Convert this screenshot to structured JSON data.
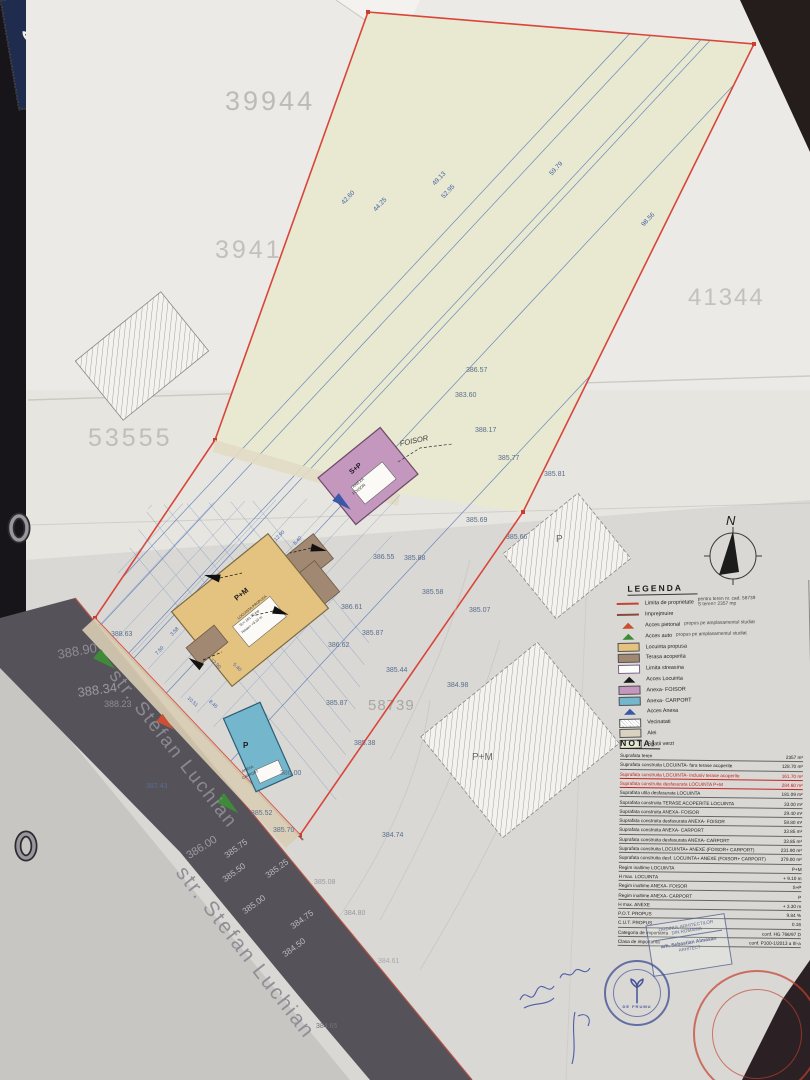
{
  "colors": {
    "boundary_red": "#d9453a",
    "parcel_green": "#e8e9d0",
    "house_tan": "#e4c380",
    "terrace_brown": "#a08873",
    "foisor_pink": "#c497bf",
    "carport_cyan": "#74b7cd",
    "street_gray": "#56525a",
    "survey_blue": "#5577b8",
    "nota_red": "#c32222"
  },
  "map": {
    "north_label": "N",
    "street_name": "str. Stefan Luchian",
    "parcel_ids": [
      "39944",
      "39416",
      "53555",
      "41344",
      "58739",
      "41344"
    ],
    "line_labels": [
      "42.60",
      "44.25",
      "49.13",
      "52.95",
      "59.79",
      "98.56"
    ],
    "dimensions": [
      "12.90",
      "5.40",
      "7.50",
      "3.58",
      "10.51",
      "8.45",
      "5.40",
      "12.90"
    ],
    "elevations": [
      "383.60",
      "388.17",
      "385.77",
      "385.81",
      "385.69",
      "385.66",
      "386.57",
      "386.55",
      "385.88",
      "385.58",
      "385.07",
      "386.61",
      "385.87",
      "386.62",
      "385.44",
      "384.98",
      "385.87",
      "385.38",
      "386.00",
      "385.52",
      "385.70",
      "384.74",
      "388.63",
      "388.90",
      "388.34",
      "388.23",
      "387.43",
      "386.00",
      "385.75",
      "385.50",
      "385.25",
      "385.08",
      "385.00",
      "384.75",
      "384.80",
      "384.50",
      "384.61",
      "384.65"
    ],
    "buildings": {
      "house": {
        "label": "P+M",
        "tag1": "LOCUINTA PROPUSA",
        "tag2": "Sc= 161.70 mp",
        "tag3": "Hmax= +9.10 m"
      },
      "foisor": {
        "label": "S+P",
        "callout": "FOISOR",
        "tag1": "ANEXA",
        "tag2": "FOISOR"
      },
      "carport": {
        "label": "P",
        "tag1": "ANEXA",
        "tag2": "CARPORT"
      },
      "neighbor_p": "P",
      "neighbor_pm": "P+M"
    }
  },
  "legend": {
    "title": "LEGENDA",
    "items": [
      {
        "label": "Limita de proprietate",
        "note": "pentru teren  nr. cad. 58739",
        "note2": "S teren= 2357 mp"
      },
      {
        "label": "Imprejmuire"
      },
      {
        "label": "Acces pietonal",
        "note": "propus pe amplasamentul studiat"
      },
      {
        "label": "Acces auto",
        "note": "propus pe amplasamentul studiat"
      },
      {
        "label": "Locuinta propusa"
      },
      {
        "label": "Terasa acoperita"
      },
      {
        "label": "Limita streasina"
      },
      {
        "label": "Acces Locuinta"
      },
      {
        "label": "Anexa- FOISOR"
      },
      {
        "label": "Anexa- CARPORT"
      },
      {
        "label": "Acces Anexa"
      },
      {
        "label": "Vecinatati"
      },
      {
        "label": "Alei"
      },
      {
        "label": "Spatii verzi"
      }
    ]
  },
  "nota": {
    "title": "NOTA!",
    "rows": [
      {
        "l": "Suprafata teren",
        "v": "2357 m²"
      },
      {
        "l": "Suprafata construita LOCUINTA- fara terase acoperite",
        "v": "128.70 m²"
      },
      {
        "l": "Suprafata construita LOCUINTA- inclusiv terase acoperite",
        "v": "161.70 m²"
      },
      {
        "l": "Suprafata construita desfasurata LOCUINTA P+M",
        "v": "284.60 m²"
      },
      {
        "l": "Suprafata utila desfasurata LOCUINTA",
        "v": "181.09 m²"
      },
      {
        "l": "Suprafata construita TERASE ACOPERITE LOCUINTA",
        "v": "33.00 m²"
      },
      {
        "l": "Suprafata construita ANEXA- FOISOR",
        "v": "29.40 m²"
      },
      {
        "l": "Suprafata construita desfasurata ANEXA- FOISOR",
        "v": "58.80 m²"
      },
      {
        "l": "Suprafata construita ANEXA- CARPORT",
        "v": "33.85 m²"
      },
      {
        "l": "Suprafata construita desfasurata ANEXA- CARPORT",
        "v": "33.85 m²"
      },
      {
        "l": "Suprafata construita LOCUINTA+ ANEXE (FOISOR+ CARPORT)",
        "v": "231.90 m²"
      },
      {
        "l": "Suprafata construita desf. LOCUINTA+ ANEXE (FOISOR+ CARPORT)",
        "v": "379.00 m²"
      },
      {
        "l": "Regim inaltime LOCUINTA",
        "v": "P+M"
      },
      {
        "l": "H max. LOCUINTA",
        "v": "+ 9.10 m"
      },
      {
        "l": "Regim inaltime ANEXA- FOISOR",
        "v": "S+P"
      },
      {
        "l": "Regim inaltime ANEXA- CARPORT",
        "v": "P"
      },
      {
        "l": "H max. ANEXE",
        "v": "+ 3.30 m"
      },
      {
        "l": "P.O.T. PROPUS",
        "v": "9.84 %"
      },
      {
        "l": "C.U.T. PROPUS",
        "v": "0.16"
      },
      {
        "l": "Categoria de importanta",
        "v": "conf. HG 766/97 D"
      },
      {
        "l": "Clasa de importanta",
        "v": "conf. P100-1/2013 a III-a"
      }
    ]
  },
  "titleblock": {
    "company": "De Frumu",
    "company_suffix": "SRL",
    "rows": [
      {
        "role": "SEF PROIECT",
        "name": "arh. SEBASTIAN ALMASAN"
      },
      {
        "role": "PROIECTAT",
        "name": "arh. SEBASTIAN ALMASAN"
      },
      {
        "role": "DESENAT",
        "name": "arh. SEBASTIAN ALMASAN"
      }
    ],
    "scara_label": "SCARA",
    "scara": "1:200",
    "beneficiar_label": "Beneficiar:",
    "beneficiar": "PRISACARIU MARIAN PETRU",
    "pr_label": "PR. NR.",
    "pr": "205/2023",
    "proiect_label": "Proiect:",
    "proiect": "CONSTRUIRE LOCUINTA INDIVIDUALA P+M, ANEXE GOSPODARESTI - FOISOR SI CARPORT, IMPREJMUIRE TEREN",
    "faza_label": "FAZA",
    "faza": "D.T.A.C.",
    "plansa_label": "Plansa:",
    "plansa": "PLAN DE SITUATIE PROPUS",
    "plansa_nr": "A.02"
  },
  "stamps": {
    "oar1": "ORDINUL ARHITECTILOR",
    "oar2": "DIN ROMANIA",
    "oar3": "arh. Sebastian Almasan",
    "oar4": "ARHITECT",
    "round_label": "DE FRUMU"
  }
}
